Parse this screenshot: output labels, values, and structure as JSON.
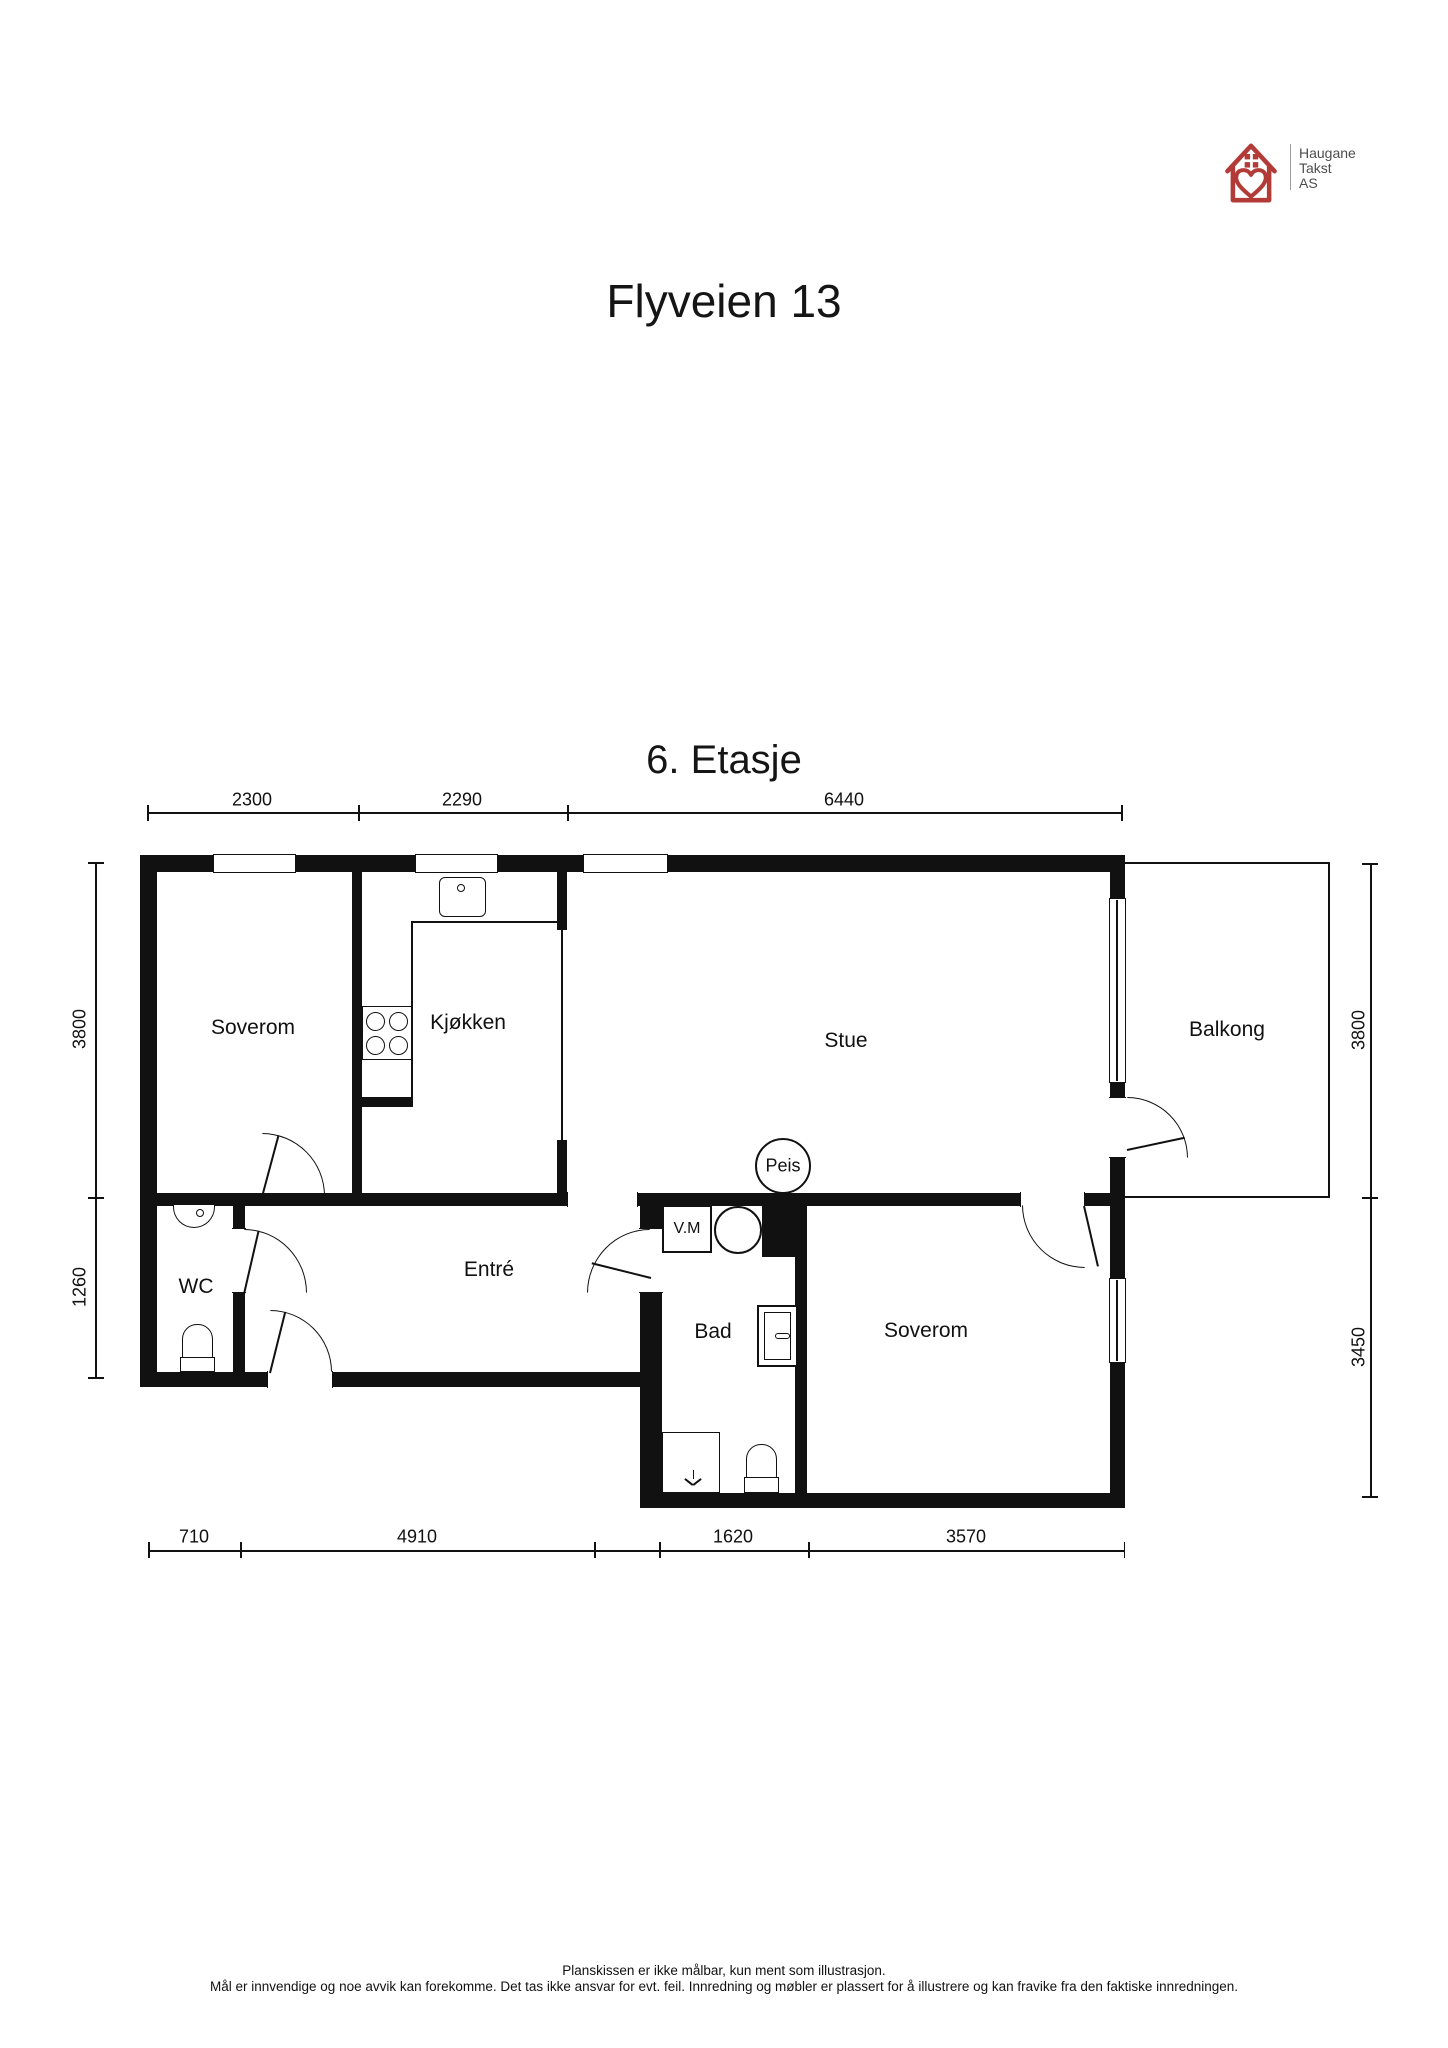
{
  "logo": {
    "line1": "Haugane",
    "line2": "Takst",
    "line3": "AS",
    "brand_color": "#b23b38",
    "text_color": "#4d4d4d"
  },
  "header": {
    "title": "Flyveien 13"
  },
  "plan": {
    "floor_label": "6. Etasje"
  },
  "rooms": {
    "soverom1": "Soverom",
    "kjokken": "Kjøkken",
    "stue": "Stue",
    "balkong": "Balkong",
    "wc": "WC",
    "entre": "Entré",
    "bad": "Bad",
    "soverom2": "Soverom"
  },
  "fixtures": {
    "washing_machine": "V.M",
    "fireplace": "Peis"
  },
  "dimensions": {
    "top": [
      "2300",
      "2290",
      "6440"
    ],
    "left": [
      "3800",
      "1260"
    ],
    "right": [
      "3800",
      "3450"
    ],
    "bottom": [
      "710",
      "4910",
      "1620",
      "3570"
    ]
  },
  "footer": {
    "line1": "Planskissen er ikke målbar, kun ment som illustrasjon.",
    "line2": "Mål er innvendige og noe avvik kan forekomme. Det tas ikke ansvar for evt. feil. Innredning og møbler er plassert for å illustrere og kan fravike fra den faktiske innredningen."
  }
}
